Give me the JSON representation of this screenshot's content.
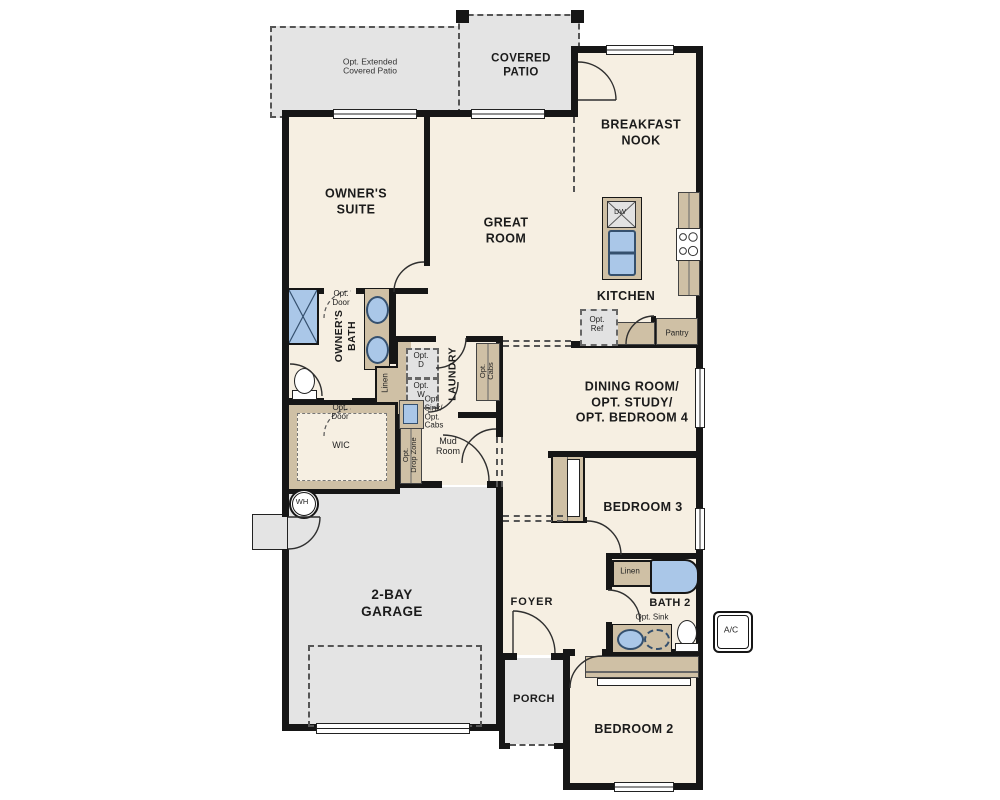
{
  "palette": {
    "floor": "#f6efe2",
    "patio_garage": "#e4e4e4",
    "cabinet_tan": "#cfc0a5",
    "fixture_blue": "#aac7e8",
    "wall": "#161616"
  },
  "labels": {
    "opt_extended_patio": "Opt. Extended\nCovered Patio",
    "covered_patio": "COVERED\nPATIO",
    "breakfast_nook": "BREAKFAST\nNOOK",
    "owners_suite": "OWNER'S\nSUITE",
    "great_room": "GREAT\nROOM",
    "kitchen": "KITCHEN",
    "dining_room": "DINING ROOM/\nOPT. STUDY/\nOPT. BEDROOM 4",
    "owners_bath": "OWNER'S\nBATH",
    "opt_door_upper": "Opt.\nDoor",
    "opt_door_lower": "Opt.\nDoor",
    "linen_owners": "Linen",
    "wic": "WIC",
    "laundry": "LAUNDRY",
    "opt_dryer": "Opt.\nD",
    "opt_washer": "Opt.\nW",
    "opt_sink_cabs": "Opt.\nSink/\nOpt.\nCabs",
    "opt_cabs": "Opt.\nCabs",
    "opt_drop_zone": "Opt.\nDrop Zone",
    "mud_room": "Mud\nRoom",
    "water_heater": "WH",
    "dishwasher": "DW",
    "opt_ref": "Opt.\nRef",
    "pantry": "Pantry",
    "garage": "2-BAY\nGARAGE",
    "foyer": "FOYER",
    "porch": "PORCH",
    "bedroom3": "BEDROOM 3",
    "linen_hall": "Linen",
    "bath2": "BATH 2",
    "opt_sink": "Opt. Sink",
    "ac_unit": "A/C",
    "bedroom2": "BEDROOM 2"
  }
}
